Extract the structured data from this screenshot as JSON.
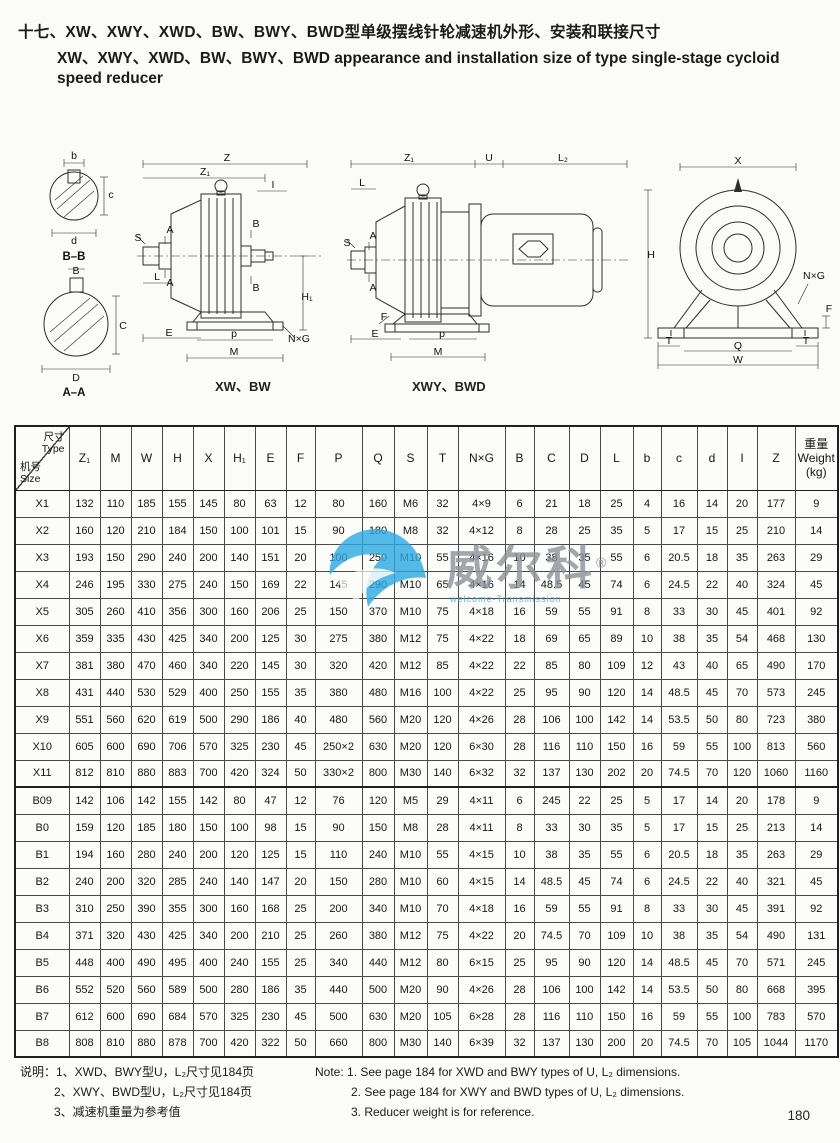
{
  "title": {
    "cn": "十七、XW、XWY、XWD、BW、BWY、BWD型单级摆线针轮减速机外形、安装和联接尺寸",
    "en1": "XW、XWY、XWD、BW、BWY、BWD appearance and installation size of type single-stage cycloid",
    "en2": "speed reducer"
  },
  "drawings": {
    "caption_left": "XW、BW",
    "caption_right": "XWY、BWD",
    "sections_labels": [
      {
        "t": "b",
        "x": 46,
        "y": 11
      },
      {
        "t": "c",
        "x": 83,
        "y": 50
      },
      {
        "t": "d",
        "x": 46,
        "y": 96
      },
      {
        "t": "B–B",
        "x": 46,
        "y": 112,
        "bold": true
      },
      {
        "t": "B",
        "x": 48,
        "y": 126
      },
      {
        "t": "C",
        "x": 95,
        "y": 181
      },
      {
        "t": "D",
        "x": 48,
        "y": 233
      },
      {
        "t": "A–A",
        "x": 46,
        "y": 248,
        "bold": true
      }
    ],
    "xw_bw_labels": [
      {
        "t": "Z",
        "x": 92,
        "y": 11
      },
      {
        "t": "Z₁",
        "x": 70,
        "y": 25
      },
      {
        "t": "I",
        "x": 138,
        "y": 38
      },
      {
        "t": "S",
        "x": 3,
        "y": 91
      },
      {
        "t": "A",
        "x": 35,
        "y": 83
      },
      {
        "t": "A",
        "x": 35,
        "y": 136
      },
      {
        "t": "L",
        "x": 22,
        "y": 130
      },
      {
        "t": "B",
        "x": 121,
        "y": 77
      },
      {
        "t": "B",
        "x": 121,
        "y": 141
      },
      {
        "t": "H₁",
        "x": 172,
        "y": 150
      },
      {
        "t": "E",
        "x": 34,
        "y": 186
      },
      {
        "t": "p",
        "x": 99,
        "y": 187
      },
      {
        "t": "M",
        "x": 99,
        "y": 205
      },
      {
        "t": "N×G",
        "x": 164,
        "y": 192
      }
    ],
    "xwy_bwd_labels": [
      {
        "t": "Z₁",
        "x": 64,
        "y": 11
      },
      {
        "t": "U",
        "x": 144,
        "y": 11
      },
      {
        "t": "L₂",
        "x": 218,
        "y": 11
      },
      {
        "t": "L",
        "x": 17,
        "y": 36
      },
      {
        "t": "S",
        "x": 2,
        "y": 96
      },
      {
        "t": "A",
        "x": 28,
        "y": 89
      },
      {
        "t": "A",
        "x": 28,
        "y": 141
      },
      {
        "t": "F",
        "x": 39,
        "y": 170
      },
      {
        "t": "E",
        "x": 30,
        "y": 187
      },
      {
        "t": "p",
        "x": 97,
        "y": 187
      },
      {
        "t": "M",
        "x": 93,
        "y": 205
      }
    ],
    "front_labels": [
      {
        "t": "X",
        "x": 98,
        "y": 10
      },
      {
        "t": "H",
        "x": 11,
        "y": 104
      },
      {
        "t": "N×G",
        "x": 174,
        "y": 125
      },
      {
        "t": "F",
        "x": 189,
        "y": 158
      },
      {
        "t": "T",
        "x": 29,
        "y": 190
      },
      {
        "t": "T",
        "x": 166,
        "y": 190
      },
      {
        "t": "Q",
        "x": 98,
        "y": 195
      },
      {
        "t": "W",
        "x": 98,
        "y": 209
      }
    ]
  },
  "watermark": {
    "brand": "威尔科",
    "reg": "®",
    "tagline": "welcome-Transmission",
    "logo_color": "#2ba9e2",
    "text_color": "#8d9298"
  },
  "table": {
    "corner": {
      "top_cn": "尺寸",
      "top_en": "Type",
      "bottom_cn": "机号",
      "bottom_en": "Size"
    },
    "columns": [
      "Z₁",
      "M",
      "W",
      "H",
      "X",
      "H₁",
      "E",
      "F",
      "P",
      "Q",
      "S",
      "T",
      "N×G",
      "B",
      "C",
      "D",
      "L",
      "b",
      "c",
      "d",
      "I",
      "Z"
    ],
    "weight_header": [
      "重量",
      "Weight",
      "(kg)"
    ],
    "rows": [
      {
        "type": "X1",
        "values": [
          "132",
          "110",
          "185",
          "155",
          "145",
          "80",
          "63",
          "12",
          "80",
          "160",
          "M6",
          "32",
          "4×9",
          "6",
          "21",
          "18",
          "25",
          "4",
          "16",
          "14",
          "20",
          "177",
          "9"
        ]
      },
      {
        "type": "X2",
        "values": [
          "160",
          "120",
          "210",
          "184",
          "150",
          "100",
          "101",
          "15",
          "90",
          "180",
          "M8",
          "32",
          "4×12",
          "8",
          "28",
          "25",
          "35",
          "5",
          "17",
          "15",
          "25",
          "210",
          "14"
        ]
      },
      {
        "type": "X3",
        "values": [
          "193",
          "150",
          "290",
          "240",
          "200",
          "140",
          "151",
          "20",
          "100",
          "250",
          "M10",
          "55",
          "4×16",
          "10",
          "38",
          "35",
          "55",
          "6",
          "20.5",
          "18",
          "35",
          "263",
          "29"
        ]
      },
      {
        "type": "X4",
        "values": [
          "246",
          "195",
          "330",
          "275",
          "240",
          "150",
          "169",
          "22",
          "145",
          "290",
          "M10",
          "65",
          "4×16",
          "14",
          "48.5",
          "45",
          "74",
          "6",
          "24.5",
          "22",
          "40",
          "324",
          "45"
        ]
      },
      {
        "type": "X5",
        "values": [
          "305",
          "260",
          "410",
          "356",
          "300",
          "160",
          "206",
          "25",
          "150",
          "370",
          "M10",
          "75",
          "4×18",
          "16",
          "59",
          "55",
          "91",
          "8",
          "33",
          "30",
          "45",
          "401",
          "92"
        ]
      },
      {
        "type": "X6",
        "values": [
          "359",
          "335",
          "430",
          "425",
          "340",
          "200",
          "125",
          "30",
          "275",
          "380",
          "M12",
          "75",
          "4×22",
          "18",
          "69",
          "65",
          "89",
          "10",
          "38",
          "35",
          "54",
          "468",
          "130"
        ]
      },
      {
        "type": "X7",
        "values": [
          "381",
          "380",
          "470",
          "460",
          "340",
          "220",
          "145",
          "30",
          "320",
          "420",
          "M12",
          "85",
          "4×22",
          "22",
          "85",
          "80",
          "109",
          "12",
          "43",
          "40",
          "65",
          "490",
          "170"
        ]
      },
      {
        "type": "X8",
        "values": [
          "431",
          "440",
          "530",
          "529",
          "400",
          "250",
          "155",
          "35",
          "380",
          "480",
          "M16",
          "100",
          "4×22",
          "25",
          "95",
          "90",
          "120",
          "14",
          "48.5",
          "45",
          "70",
          "573",
          "245"
        ]
      },
      {
        "type": "X9",
        "values": [
          "551",
          "560",
          "620",
          "619",
          "500",
          "290",
          "186",
          "40",
          "480",
          "560",
          "M20",
          "120",
          "4×26",
          "28",
          "106",
          "100",
          "142",
          "14",
          "53.5",
          "50",
          "80",
          "723",
          "380"
        ]
      },
      {
        "type": "X10",
        "values": [
          "605",
          "600",
          "690",
          "706",
          "570",
          "325",
          "230",
          "45",
          "250×2",
          "630",
          "M20",
          "120",
          "6×30",
          "28",
          "116",
          "110",
          "150",
          "16",
          "59",
          "55",
          "100",
          "813",
          "560"
        ]
      },
      {
        "type": "X11",
        "values": [
          "812",
          "810",
          "880",
          "883",
          "700",
          "420",
          "324",
          "50",
          "330×2",
          "800",
          "M30",
          "140",
          "6×32",
          "32",
          "137",
          "130",
          "202",
          "20",
          "74.5",
          "70",
          "120",
          "1060",
          "1160"
        ]
      },
      {
        "type": "B09",
        "values": [
          "142",
          "106",
          "142",
          "155",
          "142",
          "80",
          "47",
          "12",
          "76",
          "120",
          "M5",
          "29",
          "4×11",
          "6",
          "245",
          "22",
          "25",
          "5",
          "17",
          "14",
          "20",
          "178",
          "9"
        ]
      },
      {
        "type": "B0",
        "values": [
          "159",
          "120",
          "185",
          "180",
          "150",
          "100",
          "98",
          "15",
          "90",
          "150",
          "M8",
          "28",
          "4×11",
          "8",
          "33",
          "30",
          "35",
          "5",
          "17",
          "15",
          "25",
          "213",
          "14"
        ]
      },
      {
        "type": "B1",
        "values": [
          "194",
          "160",
          "280",
          "240",
          "200",
          "120",
          "125",
          "15",
          "110",
          "240",
          "M10",
          "55",
          "4×15",
          "10",
          "38",
          "35",
          "55",
          "6",
          "20.5",
          "18",
          "35",
          "263",
          "29"
        ]
      },
      {
        "type": "B2",
        "values": [
          "240",
          "200",
          "320",
          "285",
          "240",
          "140",
          "147",
          "20",
          "150",
          "280",
          "M10",
          "60",
          "4×15",
          "14",
          "48.5",
          "45",
          "74",
          "6",
          "24.5",
          "22",
          "40",
          "321",
          "45"
        ]
      },
      {
        "type": "B3",
        "values": [
          "310",
          "250",
          "390",
          "355",
          "300",
          "160",
          "168",
          "25",
          "200",
          "340",
          "M10",
          "70",
          "4×18",
          "16",
          "59",
          "55",
          "91",
          "8",
          "33",
          "30",
          "45",
          "391",
          "92"
        ]
      },
      {
        "type": "B4",
        "values": [
          "371",
          "320",
          "430",
          "425",
          "340",
          "200",
          "210",
          "25",
          "260",
          "380",
          "M12",
          "75",
          "4×22",
          "20",
          "74.5",
          "70",
          "109",
          "10",
          "38",
          "35",
          "54",
          "490",
          "131"
        ]
      },
      {
        "type": "B5",
        "values": [
          "448",
          "400",
          "490",
          "495",
          "400",
          "240",
          "155",
          "25",
          "340",
          "440",
          "M12",
          "80",
          "6×15",
          "25",
          "95",
          "90",
          "120",
          "14",
          "48.5",
          "45",
          "70",
          "571",
          "245"
        ]
      },
      {
        "type": "B6",
        "values": [
          "552",
          "520",
          "560",
          "589",
          "500",
          "280",
          "186",
          "35",
          "440",
          "500",
          "M20",
          "90",
          "4×26",
          "28",
          "106",
          "100",
          "142",
          "14",
          "53.5",
          "50",
          "80",
          "668",
          "395"
        ]
      },
      {
        "type": "B7",
        "values": [
          "612",
          "600",
          "690",
          "684",
          "570",
          "325",
          "230",
          "45",
          "500",
          "630",
          "M20",
          "105",
          "6×28",
          "28",
          "116",
          "110",
          "150",
          "16",
          "59",
          "55",
          "100",
          "783",
          "570"
        ]
      },
      {
        "type": "B8",
        "values": [
          "808",
          "810",
          "880",
          "878",
          "700",
          "420",
          "322",
          "50",
          "660",
          "800",
          "M30",
          "140",
          "6×39",
          "32",
          "137",
          "130",
          "200",
          "20",
          "74.5",
          "70",
          "105",
          "1044",
          "1170"
        ]
      }
    ]
  },
  "notes": {
    "cn": [
      "说明：1、XWD、BWY型U，L₂尺寸见184页",
      "2、XWY、BWD型U，L₂尺寸见184页",
      "3、减速机重量为参考值"
    ],
    "en": [
      "Note: 1. See page 184 for XWD and BWY types of U, L₂ dimensions.",
      "2. See page 184 for XWY and BWD types of U, L₂ dimensions.",
      "3. Reducer weight is for reference."
    ]
  },
  "page_number": "180"
}
